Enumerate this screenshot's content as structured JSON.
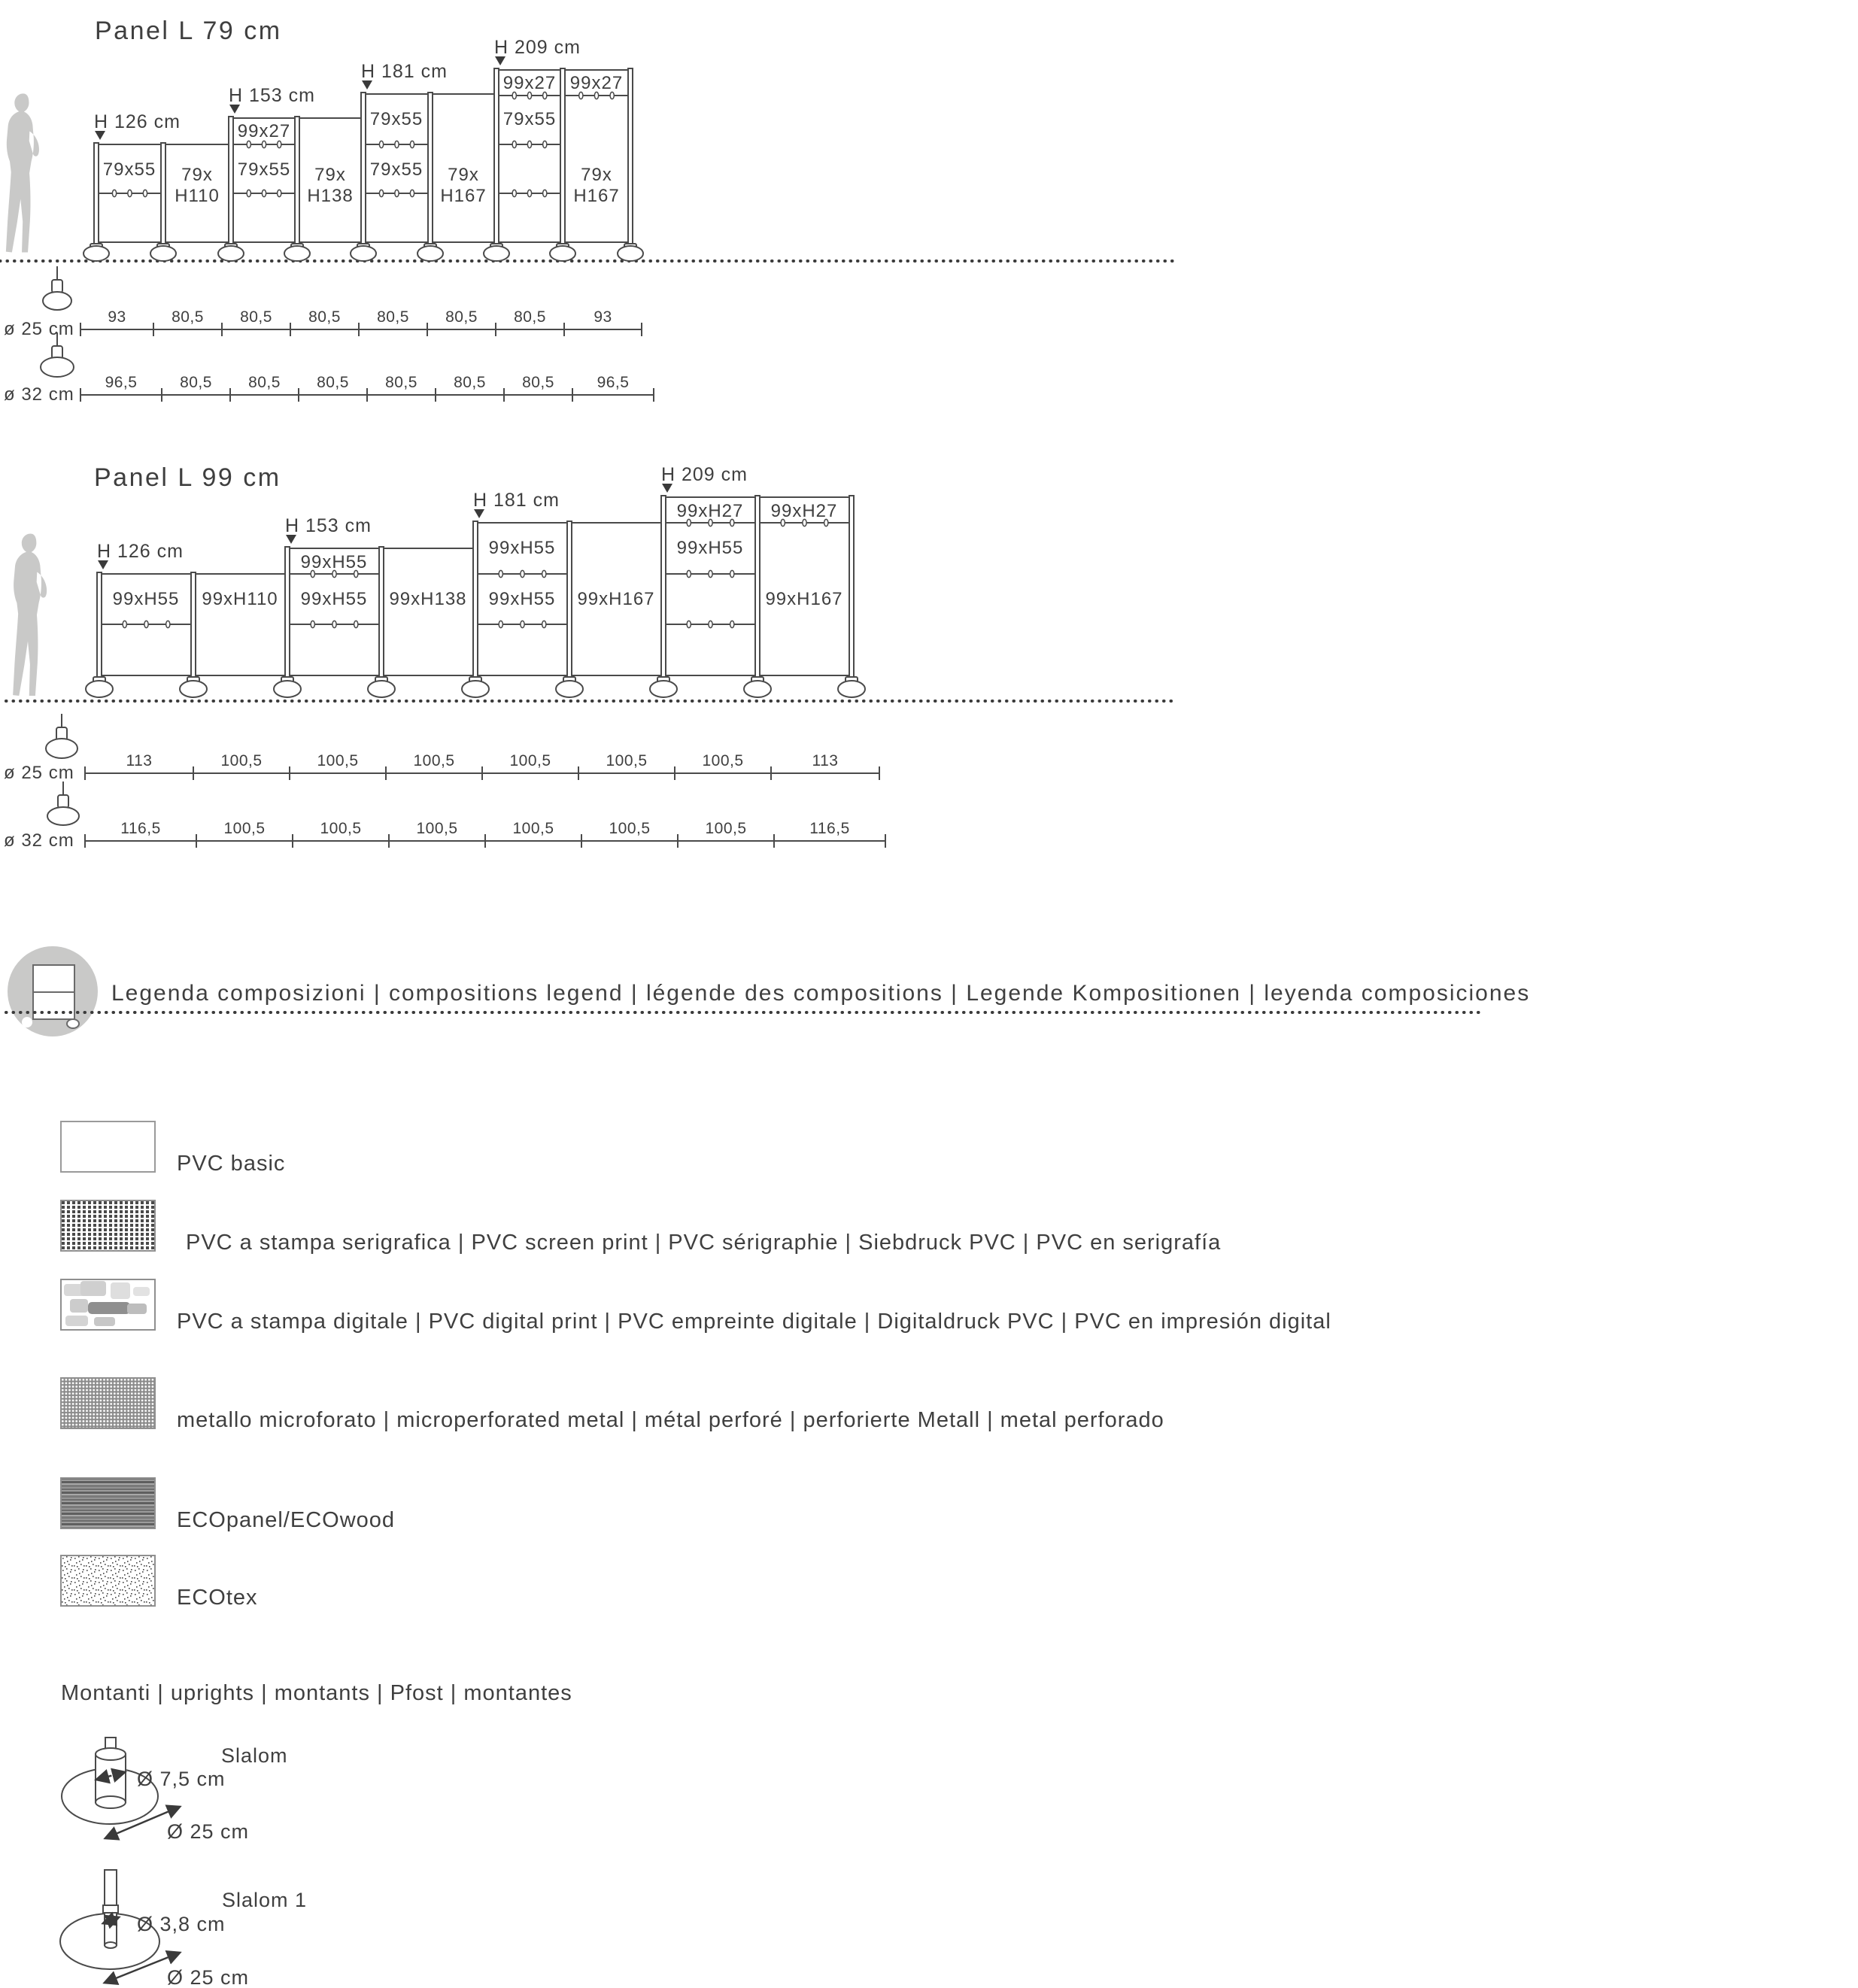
{
  "colors": {
    "line": "#4a4a4a",
    "text": "#3f3f3f",
    "silhouette": "#c9c9c8",
    "badge": "#c9c9c8"
  },
  "diagram1": {
    "title": "Panel L 79 cm",
    "height_labels": [
      "H 126 cm",
      "H 153 cm",
      "H 181 cm",
      "H 209 cm"
    ],
    "bays": [
      {
        "labels": [
          "79x55"
        ]
      },
      {
        "labels": [
          "79x",
          "H110"
        ]
      },
      {
        "labels": [
          "99x27",
          "79x55"
        ]
      },
      {
        "labels": [
          "79x",
          "H138"
        ]
      },
      {
        "labels": [
          "79x55",
          "79x55"
        ]
      },
      {
        "labels": [
          "79x",
          "H167"
        ]
      },
      {
        "labels": [
          "99x27",
          "79x55"
        ]
      },
      {
        "labels": [
          "99x27",
          "79x",
          "H167"
        ]
      }
    ],
    "dims": [
      {
        "label": "ø 25 cm",
        "segments": [
          "93",
          "80,5",
          "80,5",
          "80,5",
          "80,5",
          "80,5",
          "80,5",
          "93"
        ]
      },
      {
        "label": "ø 32 cm",
        "segments": [
          "96,5",
          "80,5",
          "80,5",
          "80,5",
          "80,5",
          "80,5",
          "80,5",
          "96,5"
        ]
      }
    ]
  },
  "diagram2": {
    "title": "Panel L 99 cm",
    "height_labels": [
      "H 126 cm",
      "H 153 cm",
      "H 181 cm",
      "H 209 cm"
    ],
    "bays": [
      {
        "labels": [
          "99xH55"
        ]
      },
      {
        "labels": [
          "99xH110"
        ]
      },
      {
        "labels": [
          "99xH55",
          "99xH55"
        ]
      },
      {
        "labels": [
          "99xH138"
        ]
      },
      {
        "labels": [
          "99xH55",
          "99xH55"
        ]
      },
      {
        "labels": [
          "99xH167"
        ]
      },
      {
        "labels": [
          "99xH27",
          "99xH55"
        ]
      },
      {
        "labels": [
          "99xH27",
          "99xH167"
        ]
      }
    ],
    "dims": [
      {
        "label": "ø 25 cm",
        "segments": [
          "113",
          "100,5",
          "100,5",
          "100,5",
          "100,5",
          "100,5",
          "100,5",
          "113"
        ]
      },
      {
        "label": "ø 32 cm",
        "segments": [
          "116,5",
          "100,5",
          "100,5",
          "100,5",
          "100,5",
          "100,5",
          "100,5",
          "116,5"
        ]
      }
    ]
  },
  "legend": {
    "header": "Legenda composizioni | compositions legend | légende des compositions | Legende Kompositionen | leyenda composiciones",
    "items": [
      {
        "pattern": "plain",
        "label": "PVC basic"
      },
      {
        "pattern": "screen-print-dots",
        "label": "PVC a stampa serigrafica | PVC screen print | PVC sérigraphie | Siebdruck PVC | PVC en serigrafía"
      },
      {
        "pattern": "digital-print-blobs",
        "label": "PVC a stampa digitale | PVC digital print | PVC empreinte digitale | Digitaldruck PVC | PVC en impresión digital"
      },
      {
        "pattern": "microperforated-metal",
        "label": "metallo microforato | microperforated metal | métal perforé | perforierte Metall | metal perforado"
      },
      {
        "pattern": "wood-stripes",
        "label": "ECOpanel/ECOwood"
      },
      {
        "pattern": "speckle",
        "label": "ECOtex"
      }
    ]
  },
  "uprights": {
    "header": "Montanti  | uprights | montants | Pfost | montantes",
    "items": [
      {
        "name": "Slalom",
        "pole_diameter": "Ø 7,5 cm",
        "base_diameter": "Ø 25 cm"
      },
      {
        "name": "Slalom 1",
        "pole_diameter": "Ø 3,8 cm",
        "base_diameter": "Ø 25 cm"
      }
    ]
  }
}
